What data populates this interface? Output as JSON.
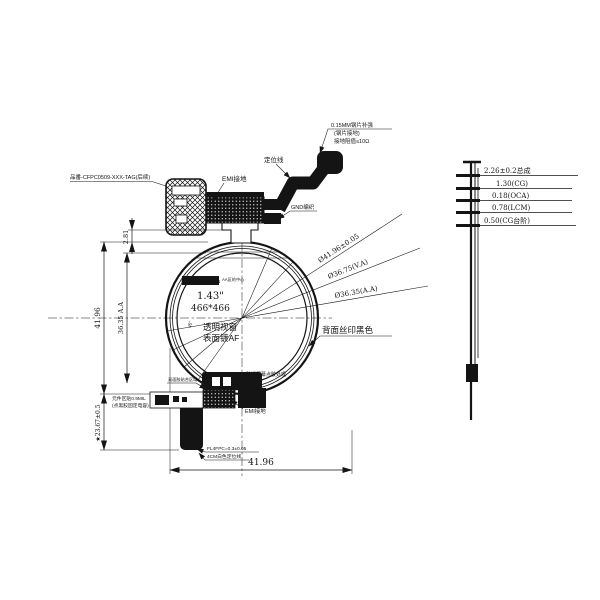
{
  "main_view": {
    "part_number": "品番-CFPC0509-XXX-TAG(后续)",
    "stiffener_note_line1": "0.15MM钢片补强",
    "stiffener_note_line2": "(钢片接地)",
    "stiffener_note_line3": "接地阻值≤10Ω",
    "positioning_line": "定位线",
    "emi_ground_top": "EMI接地",
    "gnd_braid": "GND编织",
    "scan_direction": "SCAN DIRECTION",
    "aa_center_note": "AA区的中心",
    "panel_size": "1.43\"",
    "resolution": "466*466",
    "window_line1": "透明视窗",
    "window_line2": "表面镀AF",
    "fan_angle": "45°",
    "back_print": "背面丝印黑色",
    "dia_outline": "Ø41.96±0.05",
    "dia_va": "Ø36.75(V.A)",
    "dia_aa": "Ø36.35(A.A)",
    "dim_top": "2.81",
    "dim_height": "41.96",
    "dim_aa_height": "36.35 A.A",
    "dim_tail": "★23.67±0.5",
    "dim_width": "41.96",
    "glue_note": "贴近屏幕点胶处理",
    "tape_note": "双面胶贴合区域",
    "component_note_line1": "元件区贴0.9MIL",
    "component_note_line2": "(点黑胶固定电容)",
    "emi_ground_bottom": "EMI接地",
    "fpc_note_line1": "FL4FPC=0.3±0.05",
    "fpc_note_line2": "4CM白色定位线"
  },
  "side_view": {
    "layers": [
      "2.26±0.2总成",
      "1.30(CG)",
      "0.18(OCA)",
      "0.78(LCM)",
      "0.50(CG台阶)"
    ]
  }
}
